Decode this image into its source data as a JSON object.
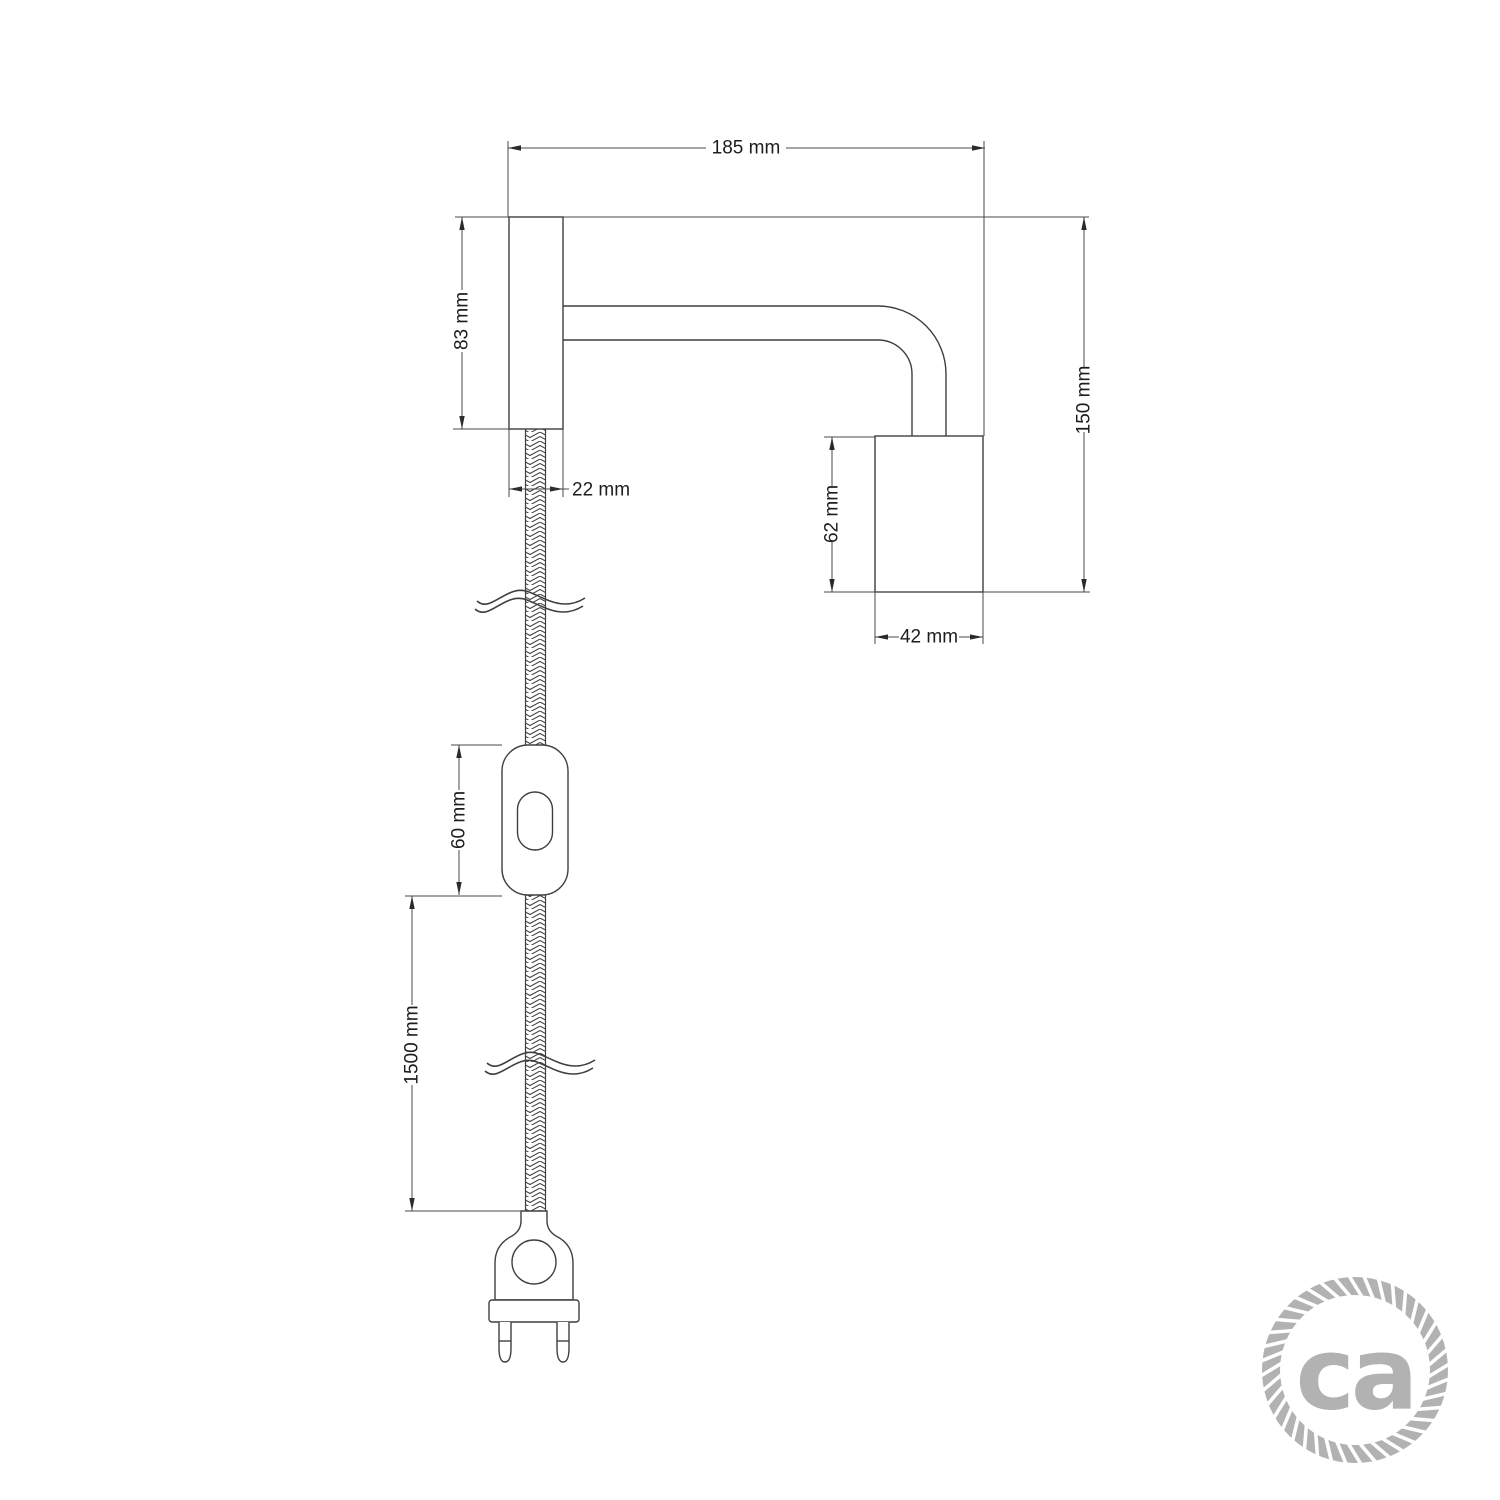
{
  "diagram": {
    "type": "technical-drawing",
    "subject": "wall spotlight with braided power cord, inline switch and two-pin plug",
    "units": "mm",
    "dimensions": {
      "arm_length": "185 mm",
      "plate_height": "83 mm",
      "plate_depth": "22 mm",
      "overall_height": "150 mm",
      "socket_height": "62 mm",
      "socket_width": "42 mm",
      "switch_length": "60 mm",
      "cable_length": "1500 mm"
    },
    "colors": {
      "line": "#3f3f3f",
      "dimension_line": "#4a4a4a",
      "text": "#1d1d1d",
      "logo_gray": "#b2b2b2",
      "background": "#ffffff"
    },
    "logo": {
      "text": "ca"
    }
  }
}
